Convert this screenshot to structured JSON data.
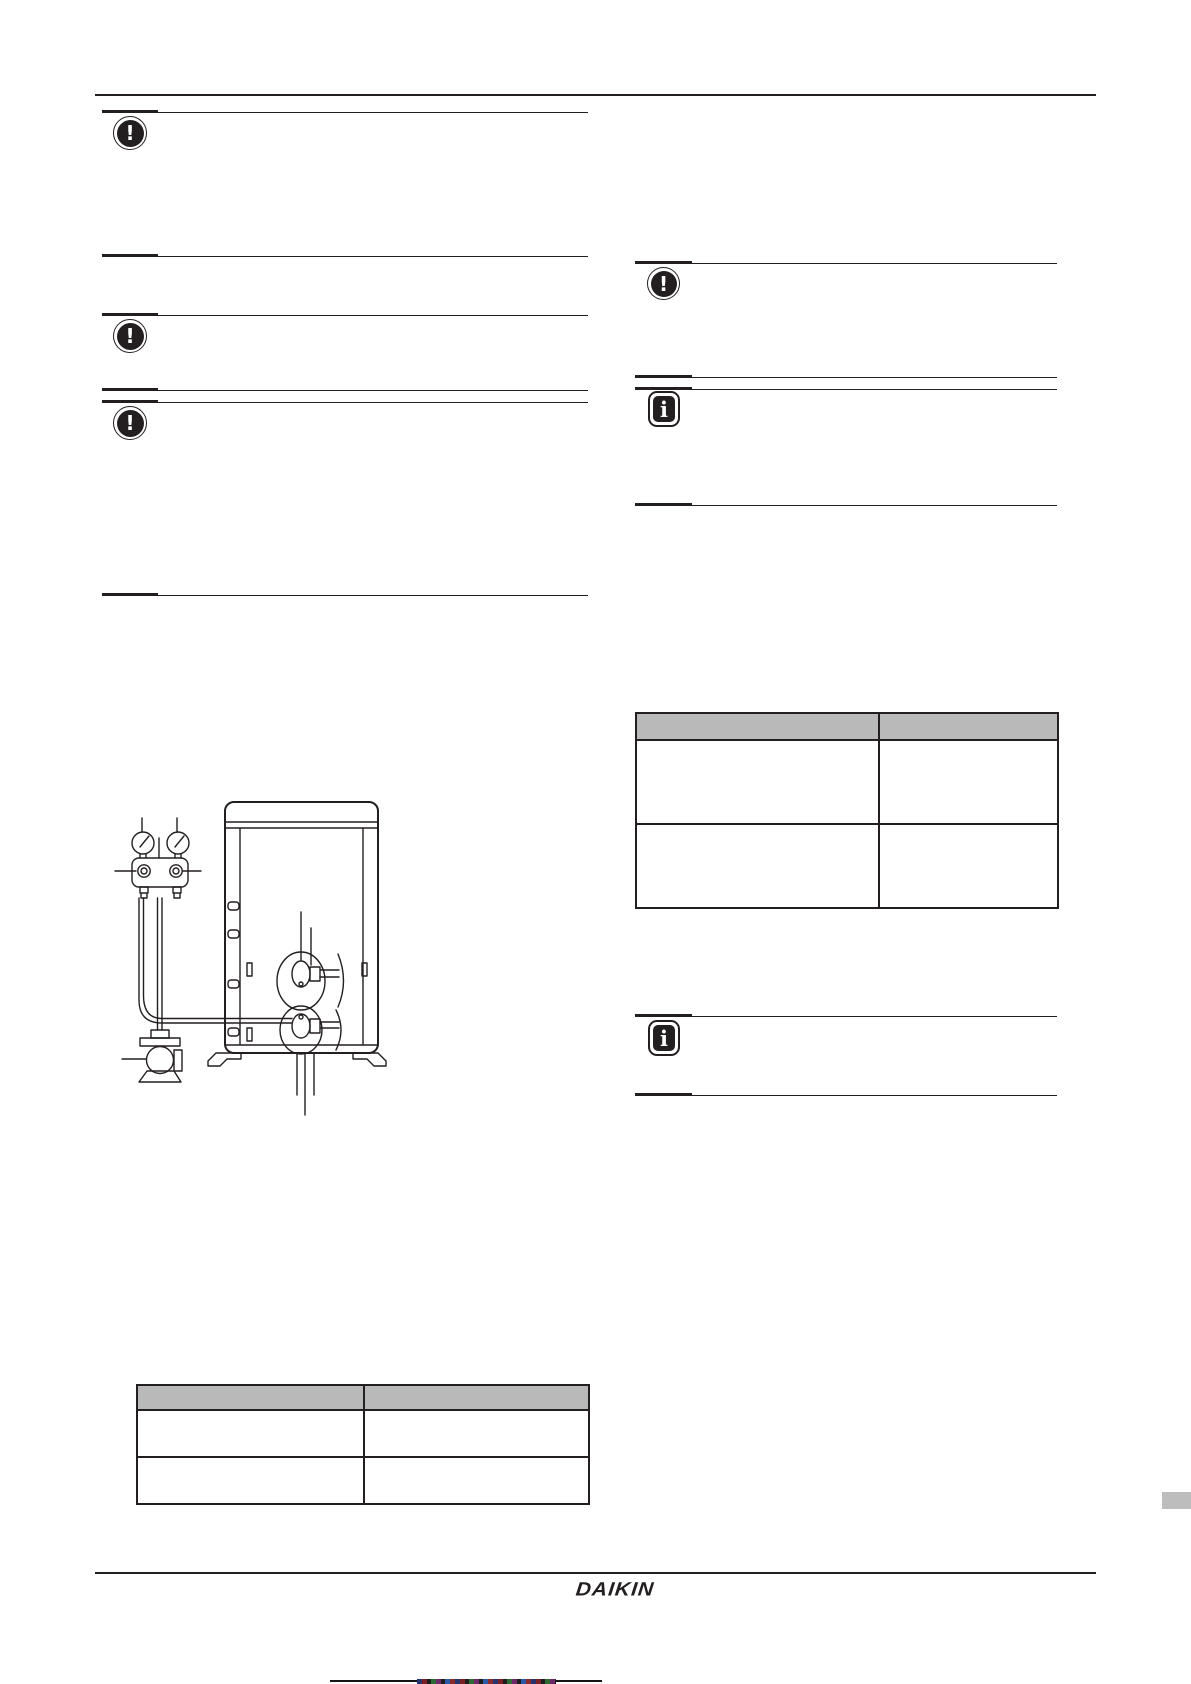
{
  "page": {
    "kind": "installation-manual-page",
    "background": "#ffffff",
    "rule_color": "#231f20"
  },
  "colors": {
    "table_header_gray": "#b9b9b9",
    "side_tab_gray": "#bdbdbd",
    "diagram_stroke": "#231f20",
    "print_bar_black": "#161616"
  },
  "callouts": {
    "left_column": [
      {
        "icon": "notice-exclamation-icon",
        "glyph": "!"
      },
      {
        "icon": "notice-exclamation-icon",
        "glyph": "!"
      },
      {
        "icon": "notice-exclamation-icon",
        "glyph": "!"
      }
    ],
    "right_column": [
      {
        "icon": "notice-exclamation-icon",
        "glyph": "!"
      },
      {
        "icon": "info-icon",
        "glyph": "i"
      },
      {
        "icon": "info-icon",
        "glyph": "i"
      }
    ]
  },
  "tables": {
    "left": {
      "header_cells": [
        "",
        ""
      ],
      "rows": [
        [
          "",
          ""
        ],
        [
          "",
          ""
        ]
      ]
    },
    "right": {
      "header_cells": [
        "",
        ""
      ],
      "rows": [
        [
          "",
          ""
        ],
        [
          "",
          ""
        ]
      ]
    }
  },
  "diagram": {
    "name": "vacuum-drying-hookup",
    "elements": [
      "pressure-gauge",
      "pressure-gauge",
      "gauge-manifold",
      "charging-hoses",
      "vacuum-pump",
      "unit-cabinet",
      "service-valves",
      "leader-lines"
    ]
  },
  "footer": {
    "brand_logo_text": "DAIKIN"
  }
}
